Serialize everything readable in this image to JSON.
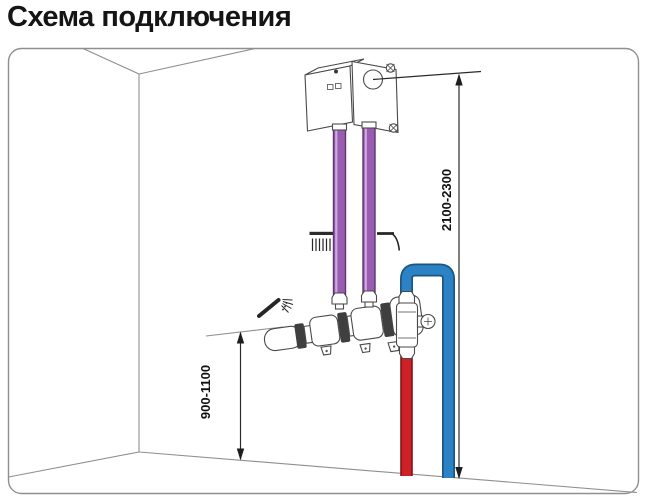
{
  "page": {
    "title": "Схема подключения"
  },
  "diagram": {
    "dimension_labels": {
      "install_height": "2100-2300",
      "valve_height": "900-1100"
    },
    "colors": {
      "mixed_hose": "#9a5cb0",
      "mixed_hose_edge": "#5f3470",
      "mixed_hose_highlight": "#cdaade",
      "cold_water": "#2b82c4",
      "cold_water_edge": "#1c567f",
      "hot_water": "#cb2127",
      "hot_water_edge": "#8a1216"
    },
    "icons": {
      "overhead_shower": "overhead-shower-icon",
      "spout_stream": "spout-icon",
      "hand_shower": "hand-shower-icon"
    }
  }
}
